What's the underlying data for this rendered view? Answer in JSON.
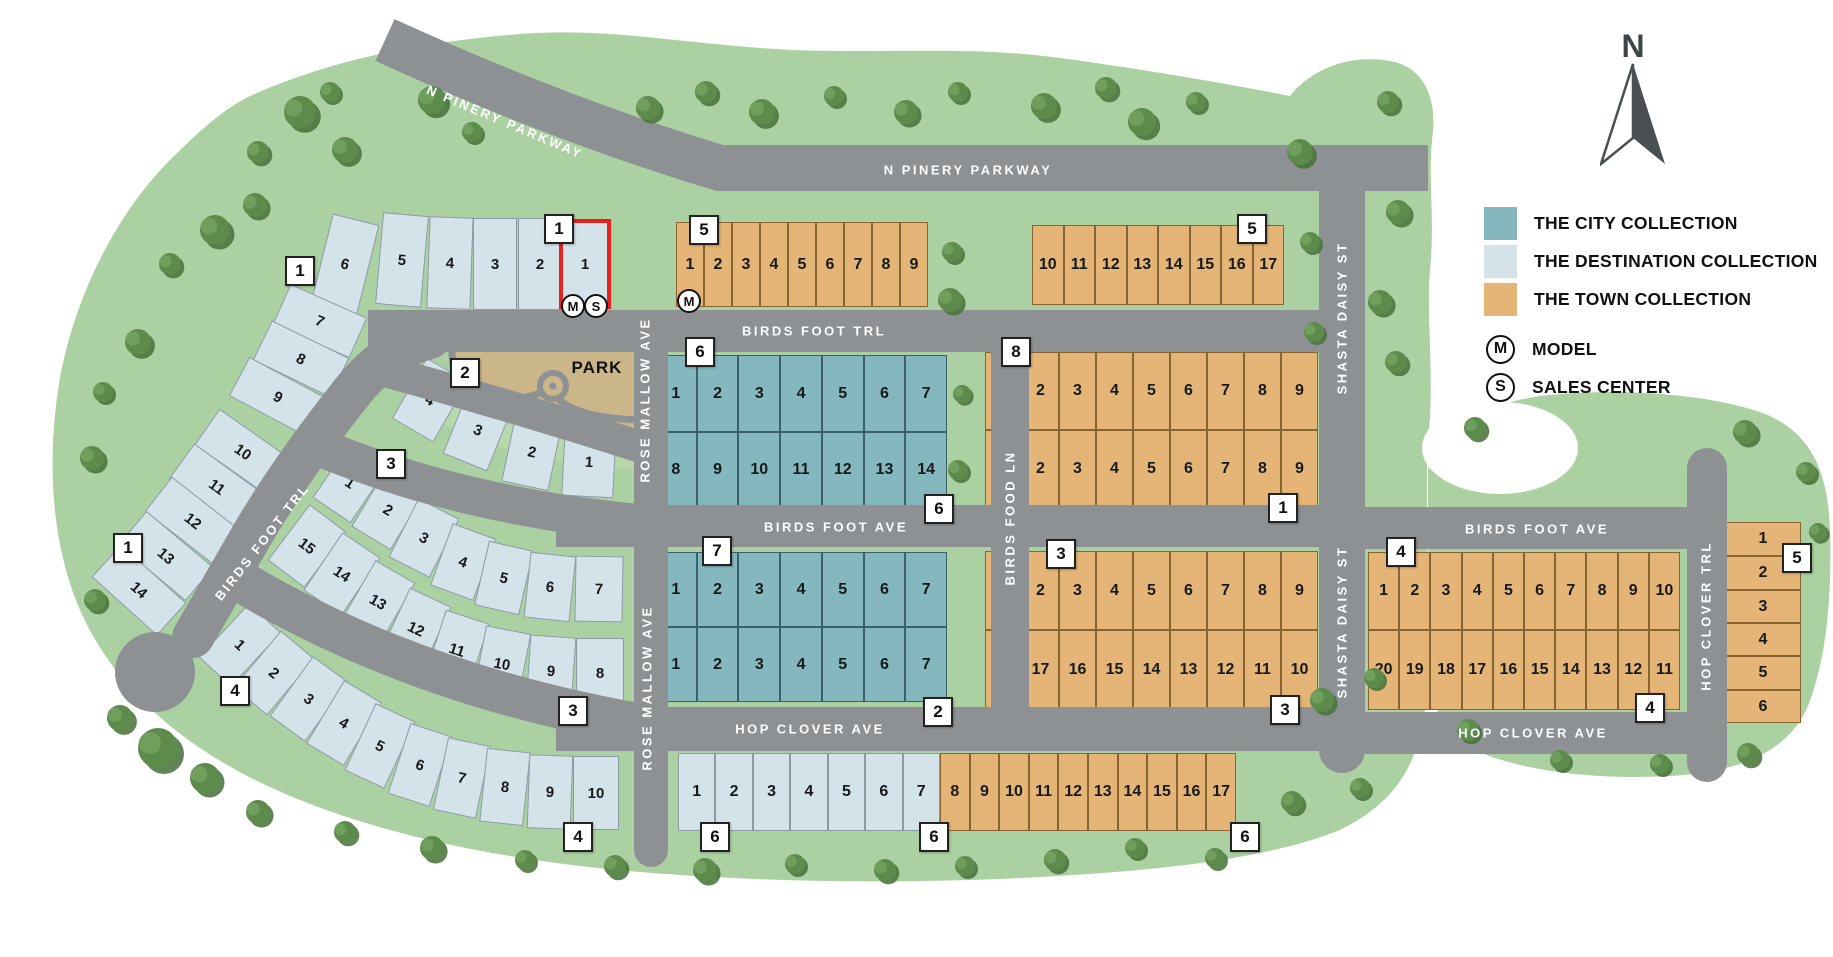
{
  "north_label": "N",
  "park_label": "PARK",
  "colors": {
    "city": "#85b7bf",
    "dest": "#d4e3e9",
    "town": "#e4b577",
    "road": "#8e9194",
    "green": "#abd1a2",
    "park_tan": "#cbb689",
    "park_green": "#b8d7ab",
    "red": "#e8211d"
  },
  "legend": {
    "items": [
      {
        "key": "city",
        "label": "THE CITY COLLECTION"
      },
      {
        "key": "dest",
        "label": "THE DESTINATION COLLECTION"
      },
      {
        "key": "town",
        "label": "THE TOWN COLLECTION"
      }
    ],
    "model_symbol": "M",
    "model_label": "MODEL",
    "sales_symbol": "S",
    "sales_label": "SALES CENTER"
  },
  "street_labels": [
    {
      "t": "N PINERY PARKWAY",
      "x": 505,
      "y": 122,
      "r": 23
    },
    {
      "t": "N PINERY PARKWAY",
      "x": 968,
      "y": 170,
      "r": 0
    },
    {
      "t": "BIRDS FOOT TRL",
      "x": 814,
      "y": 331,
      "r": 0
    },
    {
      "t": "BIRDS FOOT TRL",
      "x": 262,
      "y": 542,
      "r": -52
    },
    {
      "t": "ROSE MALLOW AVE",
      "x": 645,
      "y": 400,
      "r": -90
    },
    {
      "t": "ROSE MALLOW AVE",
      "x": 647,
      "y": 688,
      "r": -90
    },
    {
      "t": "BIRDS FOOT AVE",
      "x": 836,
      "y": 527,
      "r": 0
    },
    {
      "t": "BIRDS FOOT AVE",
      "x": 1537,
      "y": 529,
      "r": 0
    },
    {
      "t": "HOP CLOVER AVE",
      "x": 810,
      "y": 729,
      "r": 0
    },
    {
      "t": "HOP CLOVER AVE",
      "x": 1533,
      "y": 733,
      "r": 0
    },
    {
      "t": "BIRDS FOOD LN",
      "x": 1010,
      "y": 518,
      "r": -90
    },
    {
      "t": "SHASTA DAISY ST",
      "x": 1342,
      "y": 318,
      "r": -90
    },
    {
      "t": "SHASTA DAISY ST",
      "x": 1342,
      "y": 622,
      "r": -90
    },
    {
      "t": "HOP CLOVER TRL",
      "x": 1706,
      "y": 616,
      "r": -90
    }
  ],
  "markers": [
    {
      "n": "1",
      "x": 300,
      "y": 271
    },
    {
      "n": "1",
      "x": 559,
      "y": 229
    },
    {
      "n": "1",
      "x": 128,
      "y": 548
    },
    {
      "n": "2",
      "x": 465,
      "y": 373
    },
    {
      "n": "3",
      "x": 391,
      "y": 464
    },
    {
      "n": "3",
      "x": 573,
      "y": 711
    },
    {
      "n": "4",
      "x": 235,
      "y": 691
    },
    {
      "n": "4",
      "x": 578,
      "y": 837
    },
    {
      "n": "5",
      "x": 704,
      "y": 230
    },
    {
      "n": "5",
      "x": 1252,
      "y": 229
    },
    {
      "n": "6",
      "x": 700,
      "y": 352
    },
    {
      "n": "6",
      "x": 939,
      "y": 509
    },
    {
      "n": "7",
      "x": 717,
      "y": 551
    },
    {
      "n": "2",
      "x": 938,
      "y": 712
    },
    {
      "n": "8",
      "x": 1016,
      "y": 352
    },
    {
      "n": "1",
      "x": 1283,
      "y": 508
    },
    {
      "n": "3",
      "x": 1061,
      "y": 554
    },
    {
      "n": "3",
      "x": 1285,
      "y": 710
    },
    {
      "n": "6",
      "x": 715,
      "y": 837
    },
    {
      "n": "6",
      "x": 934,
      "y": 837
    },
    {
      "n": "6",
      "x": 1245,
      "y": 837
    },
    {
      "n": "4",
      "x": 1401,
      "y": 552
    },
    {
      "n": "4",
      "x": 1650,
      "y": 708
    },
    {
      "n": "5",
      "x": 1797,
      "y": 558
    }
  ],
  "badges": [
    {
      "t": "M",
      "x": 573,
      "y": 306
    },
    {
      "t": "S",
      "x": 596,
      "y": 306
    },
    {
      "t": "M",
      "x": 689,
      "y": 301
    }
  ],
  "arc_lots": [
    {
      "n": "6",
      "x": 345,
      "y": 264,
      "w": 48,
      "h": 92,
      "r": 14
    },
    {
      "n": "5",
      "x": 402,
      "y": 260,
      "w": 46,
      "h": 92,
      "r": 5
    },
    {
      "n": "4",
      "x": 450,
      "y": 263,
      "w": 44,
      "h": 92,
      "r": 2
    },
    {
      "n": "3",
      "x": 495,
      "y": 264,
      "w": 44,
      "h": 92,
      "r": 0
    },
    {
      "n": "2",
      "x": 540,
      "y": 264,
      "w": 44,
      "h": 92,
      "r": 0
    },
    {
      "n": "1",
      "x": 585,
      "y": 264,
      "w": 52,
      "h": 90,
      "r": 0,
      "red": true
    },
    {
      "n": "7",
      "x": 320,
      "y": 321,
      "w": 84,
      "h": 44,
      "r": 24
    },
    {
      "n": "8",
      "x": 301,
      "y": 359,
      "w": 86,
      "h": 44,
      "r": 26
    },
    {
      "n": "9",
      "x": 278,
      "y": 397,
      "w": 88,
      "h": 44,
      "r": 28
    },
    {
      "n": "10",
      "x": 243,
      "y": 452,
      "w": 88,
      "h": 44,
      "r": 35
    },
    {
      "n": "11",
      "x": 217,
      "y": 487,
      "w": 88,
      "h": 44,
      "r": 36
    },
    {
      "n": "12",
      "x": 193,
      "y": 521,
      "w": 88,
      "h": 44,
      "r": 38
    },
    {
      "n": "13",
      "x": 166,
      "y": 556,
      "w": 88,
      "h": 44,
      "r": 40
    },
    {
      "n": "14",
      "x": 139,
      "y": 590,
      "w": 88,
      "h": 44,
      "r": 42
    },
    {
      "n": "4",
      "x": 430,
      "y": 400,
      "w": 48,
      "h": 70,
      "r": 30
    },
    {
      "n": "3",
      "x": 478,
      "y": 430,
      "w": 48,
      "h": 70,
      "r": 22
    },
    {
      "n": "2",
      "x": 532,
      "y": 452,
      "w": 48,
      "h": 70,
      "r": 12
    },
    {
      "n": "1",
      "x": 589,
      "y": 462,
      "w": 52,
      "h": 70,
      "r": 3
    },
    {
      "n": "1",
      "x": 350,
      "y": 483,
      "w": 46,
      "h": 66,
      "r": 34
    },
    {
      "n": "2",
      "x": 388,
      "y": 510,
      "w": 46,
      "h": 66,
      "r": 31
    },
    {
      "n": "3",
      "x": 424,
      "y": 538,
      "w": 46,
      "h": 66,
      "r": 27
    },
    {
      "n": "4",
      "x": 463,
      "y": 562,
      "w": 46,
      "h": 66,
      "r": 20
    },
    {
      "n": "5",
      "x": 504,
      "y": 578,
      "w": 46,
      "h": 66,
      "r": 13
    },
    {
      "n": "6",
      "x": 550,
      "y": 587,
      "w": 46,
      "h": 66,
      "r": 6
    },
    {
      "n": "7",
      "x": 599,
      "y": 589,
      "w": 48,
      "h": 66,
      "r": 1
    },
    {
      "n": "15",
      "x": 307,
      "y": 546,
      "w": 46,
      "h": 70,
      "r": 37
    },
    {
      "n": "14",
      "x": 342,
      "y": 574,
      "w": 46,
      "h": 70,
      "r": 34
    },
    {
      "n": "13",
      "x": 378,
      "y": 602,
      "w": 46,
      "h": 70,
      "r": 30
    },
    {
      "n": "12",
      "x": 416,
      "y": 629,
      "w": 46,
      "h": 70,
      "r": 25
    },
    {
      "n": "11",
      "x": 457,
      "y": 650,
      "w": 46,
      "h": 70,
      "r": 18
    },
    {
      "n": "10",
      "x": 502,
      "y": 664,
      "w": 46,
      "h": 70,
      "r": 11
    },
    {
      "n": "9",
      "x": 551,
      "y": 671,
      "w": 46,
      "h": 70,
      "r": 4
    },
    {
      "n": "8",
      "x": 600,
      "y": 673,
      "w": 48,
      "h": 70,
      "r": 0
    },
    {
      "n": "1",
      "x": 240,
      "y": 645,
      "w": 44,
      "h": 74,
      "r": 43
    },
    {
      "n": "2",
      "x": 274,
      "y": 673,
      "w": 44,
      "h": 74,
      "r": 40
    },
    {
      "n": "3",
      "x": 309,
      "y": 699,
      "w": 44,
      "h": 74,
      "r": 36
    },
    {
      "n": "4",
      "x": 344,
      "y": 723,
      "w": 44,
      "h": 74,
      "r": 31
    },
    {
      "n": "5",
      "x": 380,
      "y": 746,
      "w": 44,
      "h": 74,
      "r": 25
    },
    {
      "n": "6",
      "x": 420,
      "y": 765,
      "w": 44,
      "h": 74,
      "r": 18
    },
    {
      "n": "7",
      "x": 462,
      "y": 778,
      "w": 44,
      "h": 74,
      "r": 12
    },
    {
      "n": "8",
      "x": 505,
      "y": 787,
      "w": 44,
      "h": 74,
      "r": 6
    },
    {
      "n": "9",
      "x": 550,
      "y": 792,
      "w": 44,
      "h": 74,
      "r": 2
    },
    {
      "n": "10",
      "x": 596,
      "y": 793,
      "w": 46,
      "h": 74,
      "r": 0
    }
  ],
  "grid_blocks": [
    {
      "c": "town",
      "x": 676,
      "w": 252,
      "rows": [
        {
          "y": 222,
          "h": 85,
          "nums": [
            "1",
            "2",
            "3",
            "4",
            "5",
            "6",
            "7",
            "8",
            "9"
          ]
        }
      ]
    },
    {
      "c": "town",
      "x": 1032,
      "w": 252,
      "rows": [
        {
          "y": 225,
          "h": 80,
          "nums": [
            "10",
            "11",
            "12",
            "13",
            "14",
            "15",
            "16",
            "17"
          ]
        }
      ]
    },
    {
      "c": "city",
      "x": 655,
      "w": 292,
      "rows": [
        {
          "y": 355,
          "h": 77,
          "nums": [
            "1",
            "2",
            "3",
            "4",
            "5",
            "6",
            "7"
          ]
        },
        {
          "y": 432,
          "h": 75,
          "nums": [
            "8",
            "9",
            "10",
            "11",
            "12",
            "13",
            "14"
          ]
        }
      ]
    },
    {
      "c": "city",
      "x": 655,
      "w": 292,
      "rows": [
        {
          "y": 552,
          "h": 75,
          "nums": [
            "1",
            "2",
            "3",
            "4",
            "5",
            "6",
            "7"
          ]
        },
        {
          "y": 627,
          "h": 75,
          "nums": [
            "1",
            "2",
            "3",
            "4",
            "5",
            "6",
            "7"
          ]
        }
      ]
    },
    {
      "c": "town",
      "x": 985,
      "w": 333,
      "rows": [
        {
          "y": 352,
          "h": 78,
          "nums": [
            "1",
            "2",
            "3",
            "4",
            "5",
            "6",
            "7",
            "8",
            "9"
          ]
        },
        {
          "y": 430,
          "h": 77,
          "nums": [
            "1",
            "2",
            "3",
            "4",
            "5",
            "6",
            "7",
            "8",
            "9"
          ]
        }
      ]
    },
    {
      "c": "town",
      "x": 985,
      "w": 333,
      "rows": [
        {
          "y": 551,
          "h": 79,
          "nums": [
            "1",
            "2",
            "3",
            "4",
            "5",
            "6",
            "7",
            "8",
            "9"
          ]
        },
        {
          "y": 630,
          "h": 79,
          "nums": [
            "18",
            "17",
            "16",
            "15",
            "14",
            "13",
            "12",
            "11",
            "10"
          ]
        }
      ]
    },
    {
      "c": "town",
      "x": 1368,
      "w": 312,
      "rows": [
        {
          "y": 552,
          "h": 78,
          "nums": [
            "1",
            "2",
            "3",
            "4",
            "5",
            "6",
            "7",
            "8",
            "9",
            "10"
          ]
        },
        {
          "y": 630,
          "h": 80,
          "nums": [
            "20",
            "19",
            "18",
            "17",
            "16",
            "15",
            "14",
            "13",
            "12",
            "11"
          ]
        }
      ]
    },
    {
      "c": "town",
      "x": 1725,
      "w": 76,
      "rows": [
        {
          "y": 522,
          "h": 34,
          "nums": [
            "1"
          ]
        },
        {
          "y": 556,
          "h": 34,
          "nums": [
            "2"
          ]
        },
        {
          "y": 590,
          "h": 33,
          "nums": [
            "3"
          ]
        },
        {
          "y": 623,
          "h": 33,
          "nums": [
            "4"
          ]
        },
        {
          "y": 656,
          "h": 34,
          "nums": [
            "5"
          ]
        },
        {
          "y": 690,
          "h": 33,
          "nums": [
            "6"
          ]
        }
      ]
    },
    {
      "c": "dest",
      "x": 678,
      "w": 262,
      "rows": [
        {
          "y": 753,
          "h": 78,
          "nums": [
            "1",
            "2",
            "3",
            "4",
            "5",
            "6",
            "7"
          ]
        }
      ]
    },
    {
      "c": "town",
      "x": 940,
      "w": 296,
      "rows": [
        {
          "y": 753,
          "h": 78,
          "nums": [
            "8",
            "9",
            "10",
            "11",
            "12",
            "13",
            "14",
            "15",
            "16",
            "17"
          ]
        }
      ]
    }
  ]
}
